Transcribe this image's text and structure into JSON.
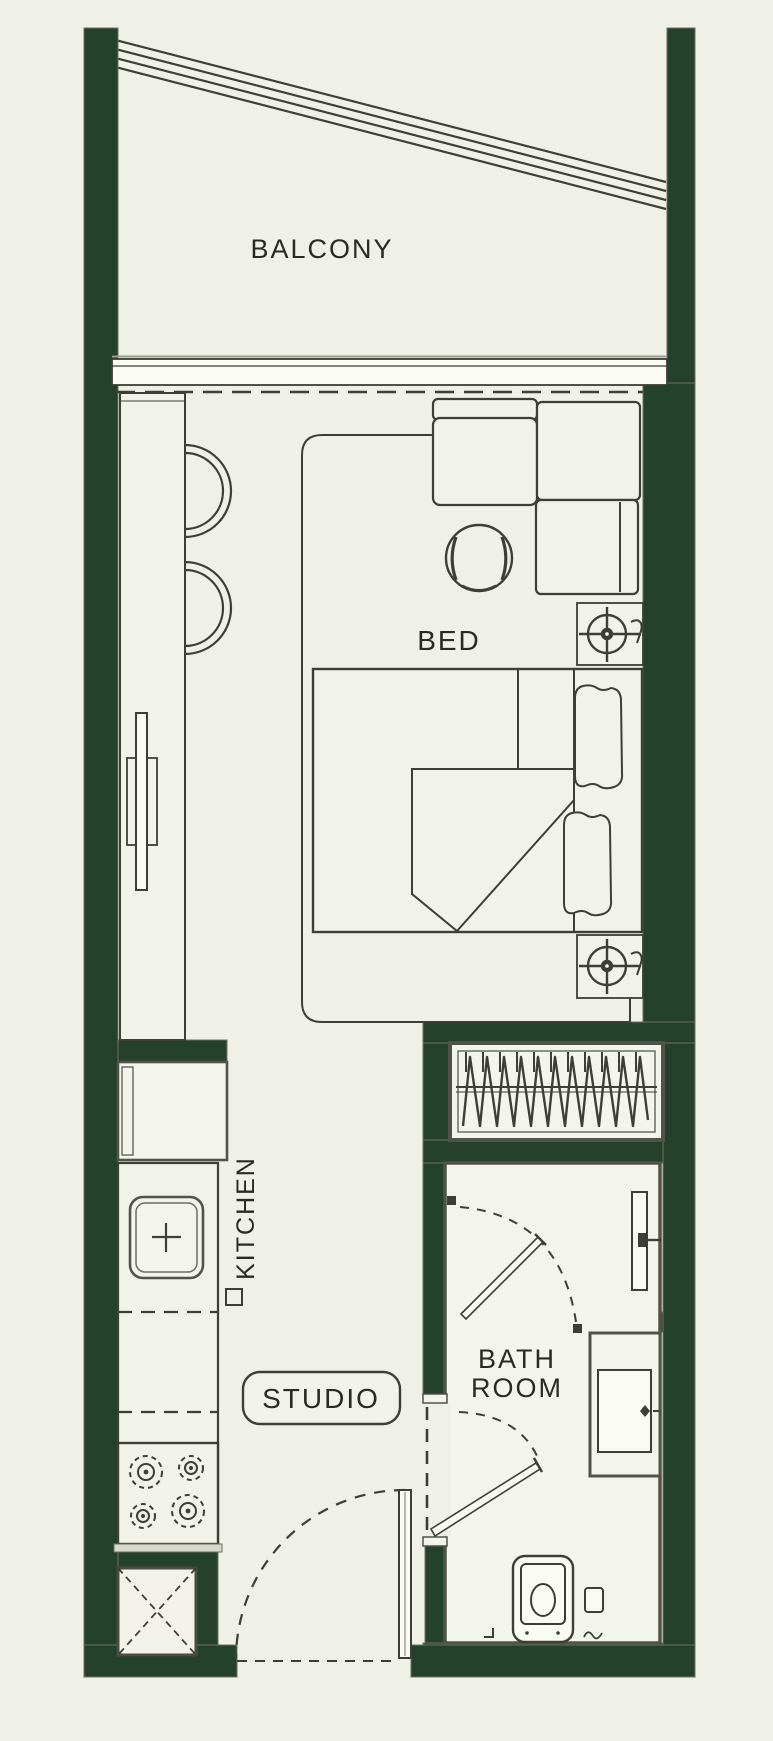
{
  "plan": {
    "title": "Studio apartment floor plan",
    "labels": {
      "balcony": "BALCONY",
      "bed": "BED",
      "kitchen": "KITCHEN",
      "studio": "STUDIO",
      "bath_line1": "BATH",
      "bath_line2": "ROOM"
    },
    "rooms": [
      "BALCONY",
      "BED",
      "KITCHEN",
      "STUDIO",
      "BATH ROOM"
    ],
    "furniture_symbols": [
      "balcony-railing",
      "sliding-window",
      "kitchen-counter-strip",
      "counter-stool",
      "tv-unit",
      "bed-platform",
      "sectional-sofa",
      "lounge-chair",
      "bedside-lamp",
      "double-bed",
      "pillow",
      "wardrobe-rail",
      "refrigerator",
      "kitchen-sink",
      "gas-stove",
      "service-shaft",
      "bathroom-door",
      "shower-screen",
      "vanity-sink",
      "toilet",
      "entry-door"
    ],
    "colors": {
      "wall": "#24422b",
      "floor": "#eff0e8",
      "fill": "#f1f2ea",
      "line": "#3d3e36",
      "frame": "#51524a",
      "text": "#292a22"
    }
  }
}
